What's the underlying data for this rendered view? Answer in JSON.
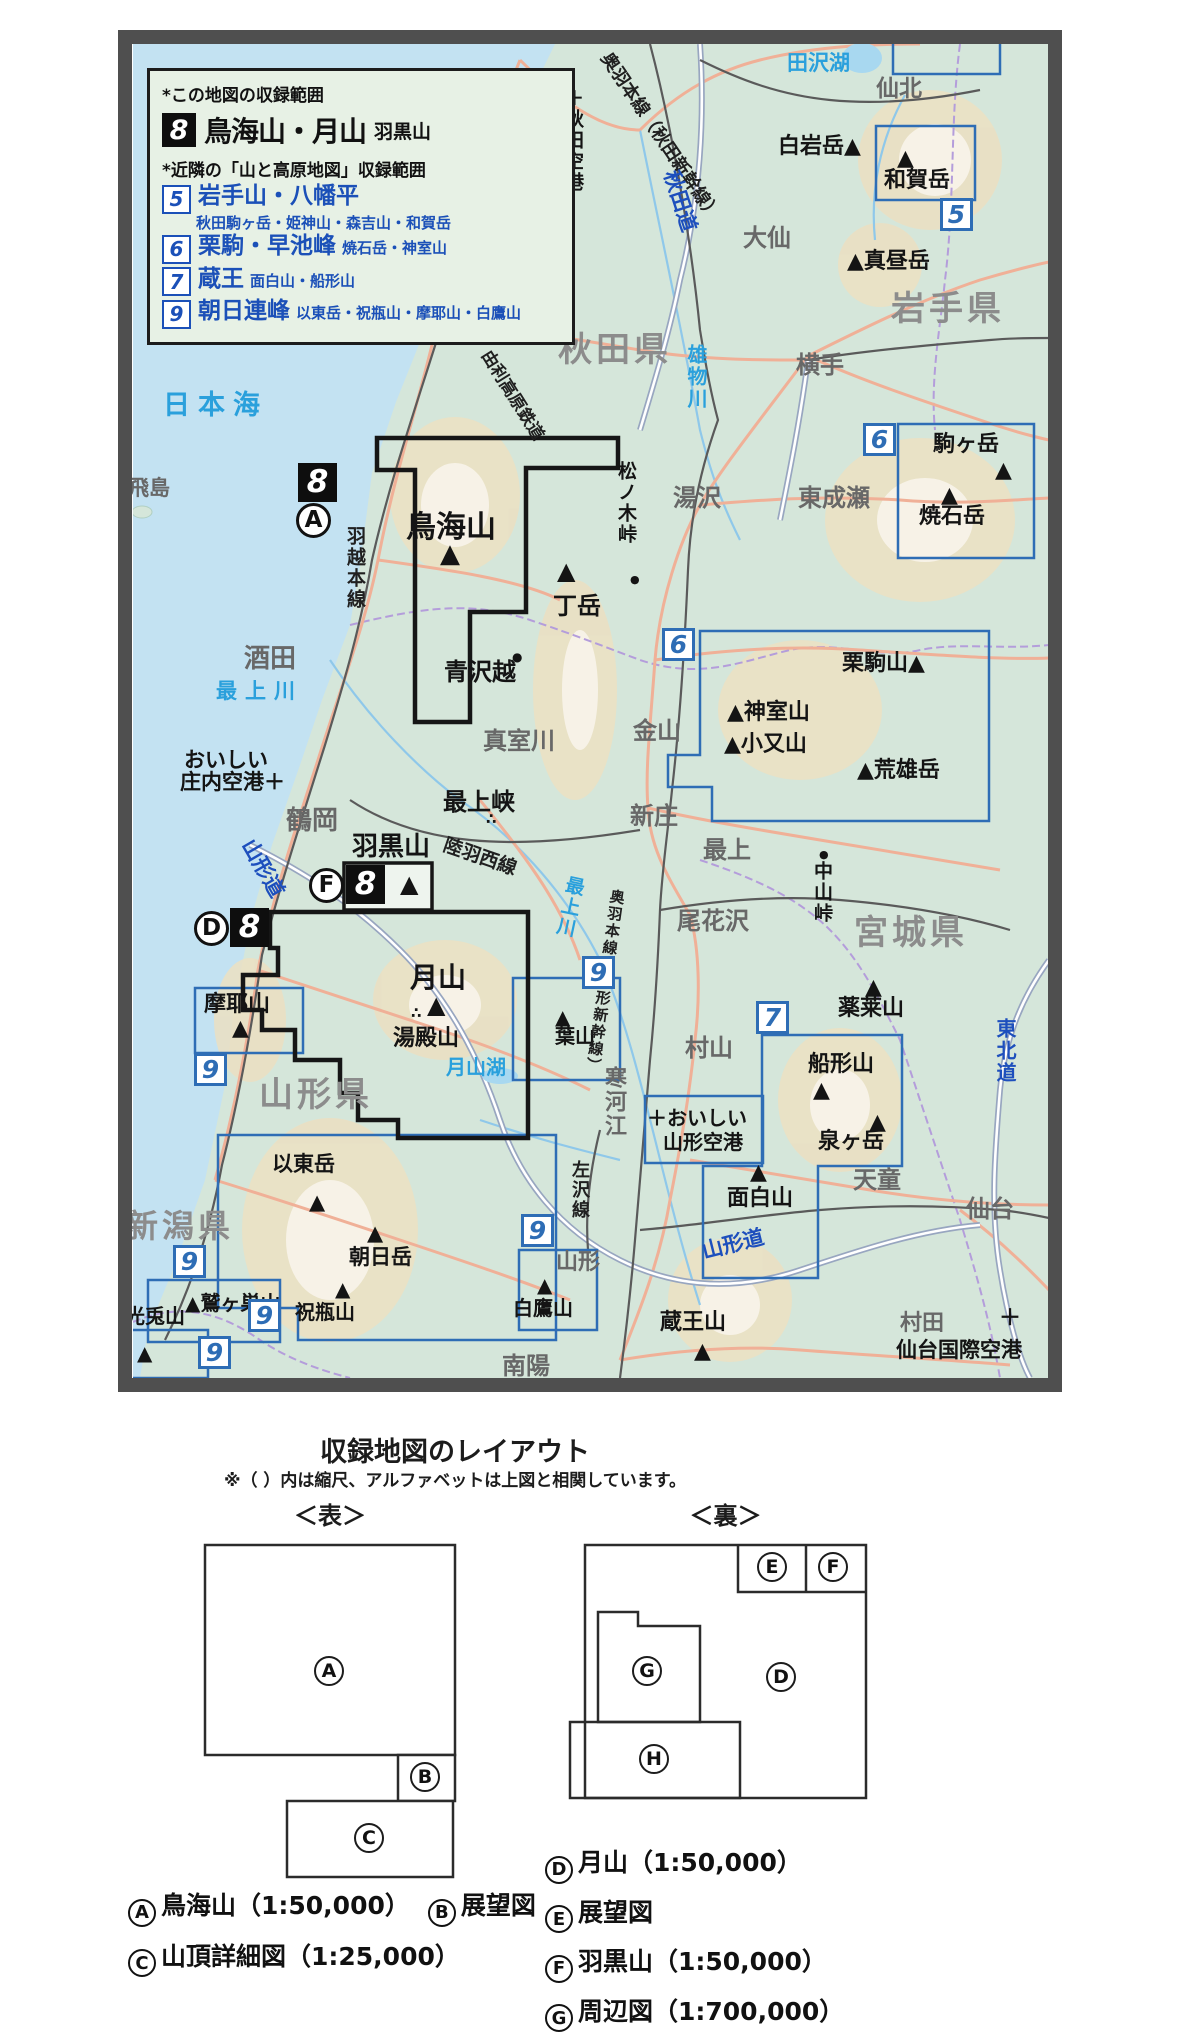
{
  "legend": {
    "note_this": "*この地図の収録範囲",
    "main": {
      "num": "8",
      "title": "鳥海山・月山",
      "sub": "羽黒山"
    },
    "note_nearby": "*近隣の「山と高原地図」収録範囲",
    "items": [
      {
        "num": "5",
        "title": "岩手山・八幡平",
        "sub": "秋田駒ヶ岳・姫神山・森吉山・和賀岳",
        "wrap": true
      },
      {
        "num": "6",
        "title": "栗駒・早池峰",
        "sub": "焼石岳・神室山"
      },
      {
        "num": "7",
        "title": "蔵王",
        "sub": "面白山・船形山"
      },
      {
        "num": "9",
        "title": "朝日連峰",
        "sub": "以東岳・祝瓶山・摩耶山・白鷹山"
      }
    ]
  },
  "map": {
    "sea_color": "#c3e2f2",
    "land_color": "#d5e6da",
    "coverage_box_color": "#2e6db5",
    "region_border_color": "#161616",
    "labels": [
      {
        "n": "label-nihonkai",
        "t": "日本海",
        "x": 163,
        "y": 392,
        "c": "water ls",
        "f": 27
      },
      {
        "n": "label-tazawako",
        "t": "田沢湖",
        "x": 787,
        "y": 53,
        "c": "water",
        "f": 21
      },
      {
        "n": "label-omonogawa",
        "t": "雄物川",
        "x": 686,
        "y": 344,
        "c": "water v",
        "f": 20
      },
      {
        "n": "label-mogamigawa",
        "t": "最上川",
        "x": 216,
        "y": 681,
        "c": "water ls",
        "f": 21
      },
      {
        "n": "label-mogamigawa-2",
        "t": "最上川",
        "x": 566,
        "y": 874,
        "c": "water v",
        "f": 19,
        "r": 12
      },
      {
        "n": "label-gassanko",
        "t": "月山湖",
        "x": 446,
        "y": 1057,
        "c": "water",
        "f": 20
      },
      {
        "n": "label-akita-pref",
        "t": "秋田県",
        "x": 558,
        "y": 333,
        "c": "pref",
        "f": 34
      },
      {
        "n": "label-iwate-pref",
        "t": "岩手県",
        "x": 891,
        "y": 292,
        "c": "pref",
        "f": 34
      },
      {
        "n": "label-miyagi-pref",
        "t": "宮城県",
        "x": 854,
        "y": 916,
        "c": "pref",
        "f": 34
      },
      {
        "n": "label-yamagata-pref",
        "t": "山形県",
        "x": 259,
        "y": 1078,
        "c": "pref",
        "f": 34
      },
      {
        "n": "label-niigata-pref",
        "t": "新潟県",
        "x": 126,
        "y": 1210,
        "c": "pref",
        "f": 32
      },
      {
        "n": "label-senboku",
        "t": "仙北",
        "x": 876,
        "y": 78,
        "c": "city",
        "f": 23
      },
      {
        "n": "label-daisen",
        "t": "大仙",
        "x": 743,
        "y": 226,
        "c": "city",
        "f": 24
      },
      {
        "n": "label-yokote",
        "t": "横手",
        "x": 796,
        "y": 353,
        "c": "city",
        "f": 24
      },
      {
        "n": "label-yurihonjo",
        "t": "由利本荘",
        "x": 473,
        "y": 307,
        "c": "city",
        "f": 22
      },
      {
        "n": "label-yuzawa",
        "t": "湯沢",
        "x": 673,
        "y": 486,
        "c": "city",
        "f": 24
      },
      {
        "n": "label-higashinaruse",
        "t": "東成瀬",
        "x": 798,
        "y": 486,
        "c": "city",
        "f": 24
      },
      {
        "n": "label-sakata",
        "t": "酒田",
        "x": 244,
        "y": 646,
        "c": "city",
        "f": 26
      },
      {
        "n": "label-tsuruoka",
        "t": "鶴岡",
        "x": 286,
        "y": 808,
        "c": "city",
        "f": 26
      },
      {
        "n": "label-mamurogawa",
        "t": "真室川",
        "x": 483,
        "y": 729,
        "c": "city",
        "f": 24
      },
      {
        "n": "label-kaneyama",
        "t": "金山",
        "x": 633,
        "y": 719,
        "c": "city",
        "f": 24
      },
      {
        "n": "label-shinjo",
        "t": "新庄",
        "x": 630,
        "y": 804,
        "c": "city",
        "f": 24
      },
      {
        "n": "label-mogami",
        "t": "最上",
        "x": 703,
        "y": 838,
        "c": "city",
        "f": 24
      },
      {
        "n": "label-obanazawa",
        "t": "尾花沢",
        "x": 677,
        "y": 909,
        "c": "city",
        "f": 24
      },
      {
        "n": "label-murayama",
        "t": "村山",
        "x": 685,
        "y": 1036,
        "c": "city",
        "f": 24
      },
      {
        "n": "label-tendo",
        "t": "天童",
        "x": 853,
        "y": 1168,
        "c": "city",
        "f": 24
      },
      {
        "n": "label-sagae",
        "t": "寒河江",
        "x": 602,
        "y": 1066,
        "c": "city v",
        "f": 22
      },
      {
        "n": "label-nanyo",
        "t": "南陽",
        "x": 502,
        "y": 1354,
        "c": "city",
        "f": 24
      },
      {
        "n": "label-sendai",
        "t": "仙台",
        "x": 966,
        "y": 1197,
        "c": "city",
        "f": 24
      },
      {
        "n": "label-murata",
        "t": "村田",
        "x": 900,
        "y": 1313,
        "c": "city",
        "f": 22
      },
      {
        "n": "label-yamagata-city",
        "t": "山形",
        "x": 556,
        "y": 1252,
        "c": "city",
        "f": 22
      },
      {
        "n": "label-tobishima",
        "t": "飛島",
        "x": 128,
        "y": 478,
        "c": "city",
        "f": 21
      },
      {
        "n": "label-shiraiwadake",
        "t": "白岩岳▲",
        "x": 778,
        "y": 136,
        "c": "mtn",
        "f": 22
      },
      {
        "n": "label-mahirudake",
        "t": "▲真昼岳",
        "x": 847,
        "y": 251,
        "c": "mtn",
        "f": 22
      },
      {
        "n": "mark-wagadake",
        "t": "▲",
        "x": 897,
        "y": 148,
        "c": "mtn",
        "f": 22
      },
      {
        "n": "label-wagadake",
        "t": "和賀岳",
        "x": 884,
        "y": 170,
        "c": "mtn",
        "f": 22
      },
      {
        "n": "label-komagatake",
        "t": "駒ヶ岳",
        "x": 933,
        "y": 434,
        "c": "mtn",
        "f": 22
      },
      {
        "n": "mark-komagatake",
        "t": "▲",
        "x": 995,
        "y": 460,
        "c": "mtn",
        "f": 22
      },
      {
        "n": "mark-yakeishidake",
        "t": "▲",
        "x": 941,
        "y": 485,
        "c": "mtn",
        "f": 22
      },
      {
        "n": "label-yakeishidake",
        "t": "焼石岳",
        "x": 919,
        "y": 506,
        "c": "mtn",
        "f": 22
      },
      {
        "n": "label-chokaisan",
        "t": "鳥海山",
        "x": 406,
        "y": 513,
        "c": "mtn",
        "f": 30
      },
      {
        "n": "mark-chokaisan",
        "t": "▲",
        "x": 440,
        "y": 541,
        "c": "mtn",
        "f": 26
      },
      {
        "n": "mark-hinokamidake",
        "t": "▲",
        "x": 557,
        "y": 559,
        "c": "mtn",
        "f": 24
      },
      {
        "n": "label-hinokamidake",
        "t": "丁岳",
        "x": 553,
        "y": 594,
        "c": "mtn",
        "f": 24
      },
      {
        "n": "label-kurikomayama",
        "t": "栗駒山▲",
        "x": 842,
        "y": 653,
        "c": "mtn",
        "f": 22
      },
      {
        "n": "label-kamuroyama",
        "t": "▲神室山",
        "x": 727,
        "y": 702,
        "c": "mtn",
        "f": 22
      },
      {
        "n": "label-komatayama",
        "t": "▲小又山",
        "x": 724,
        "y": 734,
        "c": "mtn",
        "f": 22
      },
      {
        "n": "label-araodake",
        "t": "▲荒雄岳",
        "x": 857,
        "y": 760,
        "c": "mtn",
        "f": 22
      },
      {
        "n": "mark-yakuraisan",
        "t": "▲",
        "x": 865,
        "y": 977,
        "c": "mtn",
        "f": 22
      },
      {
        "n": "label-yakuraisan",
        "t": "薬莱山",
        "x": 838,
        "y": 998,
        "c": "mtn",
        "f": 22
      },
      {
        "n": "label-funagatayama",
        "t": "船形山",
        "x": 808,
        "y": 1054,
        "c": "mtn",
        "f": 22
      },
      {
        "n": "mark-funagatayama",
        "t": "▲",
        "x": 813,
        "y": 1080,
        "c": "mtn",
        "f": 22
      },
      {
        "n": "mark-izumigatake",
        "t": "▲",
        "x": 869,
        "y": 1112,
        "c": "mtn",
        "f": 22
      },
      {
        "n": "label-izumigatake",
        "t": "泉ヶ岳",
        "x": 818,
        "y": 1131,
        "c": "mtn",
        "f": 22
      },
      {
        "n": "mark-omoshiroyama",
        "t": "▲",
        "x": 750,
        "y": 1162,
        "c": "mtn",
        "f": 22
      },
      {
        "n": "label-omoshiroyama",
        "t": "面白山",
        "x": 727,
        "y": 1188,
        "c": "mtn",
        "f": 22
      },
      {
        "n": "label-zaozan",
        "t": "蔵王山",
        "x": 660,
        "y": 1312,
        "c": "mtn",
        "f": 22
      },
      {
        "n": "mark-zaozan",
        "t": "▲",
        "x": 694,
        "y": 1341,
        "c": "mtn",
        "f": 22
      },
      {
        "n": "label-gassan",
        "t": "月山",
        "x": 410,
        "y": 964,
        "c": "mtn",
        "f": 28
      },
      {
        "n": "mark-gassan",
        "t": "▲",
        "x": 427,
        "y": 993,
        "c": "mtn",
        "f": 24
      },
      {
        "n": "dots-yudonosan",
        "t": "∴",
        "x": 411,
        "y": 1006,
        "c": "mtn",
        "f": 15
      },
      {
        "n": "label-yudonosan",
        "t": "湯殿山",
        "x": 393,
        "y": 1028,
        "c": "mtn",
        "f": 22
      },
      {
        "n": "label-hagurosan",
        "t": "羽黒山",
        "x": 352,
        "y": 834,
        "c": "mtn",
        "f": 26
      },
      {
        "n": "mark-hagurosan",
        "t": "▲",
        "x": 400,
        "y": 872,
        "c": "mtn",
        "f": 24
      },
      {
        "n": "label-mayasan",
        "t": "摩耶山",
        "x": 204,
        "y": 994,
        "c": "mtn",
        "f": 22
      },
      {
        "n": "mark-mayasan",
        "t": "▲",
        "x": 232,
        "y": 1018,
        "c": "mtn",
        "f": 22
      },
      {
        "n": "mark-hayama",
        "t": "▲",
        "x": 555,
        "y": 1007,
        "c": "mtn",
        "f": 20
      },
      {
        "n": "label-hayama",
        "t": "葉山",
        "x": 555,
        "y": 1026,
        "c": "mtn",
        "f": 20
      },
      {
        "n": "label-itodake",
        "t": "以東岳",
        "x": 272,
        "y": 1154,
        "c": "mtn",
        "f": 21
      },
      {
        "n": "mark-itodake",
        "t": "▲",
        "x": 309,
        "y": 1192,
        "c": "mtn",
        "f": 21
      },
      {
        "n": "label-washigasuyama",
        "t": "▲鷲ヶ巣山",
        "x": 185,
        "y": 1293,
        "c": "mtn",
        "f": 20
      },
      {
        "n": "label-kosagiyama",
        "t": "光兎山",
        "x": 125,
        "y": 1306,
        "c": "mtn",
        "f": 20
      },
      {
        "n": "mark-kosagiyama",
        "t": "▲",
        "x": 137,
        "y": 1343,
        "c": "mtn",
        "f": 20
      },
      {
        "n": "mark-asahidake",
        "t": "▲",
        "x": 367,
        "y": 1223,
        "c": "mtn",
        "f": 21
      },
      {
        "n": "label-asahidake",
        "t": "朝日岳",
        "x": 349,
        "y": 1247,
        "c": "mtn",
        "f": 21
      },
      {
        "n": "mark-iwaibegamiyama",
        "t": "▲",
        "x": 335,
        "y": 1279,
        "c": "mtn",
        "f": 20
      },
      {
        "n": "label-iwaibegamiyama",
        "t": "祝瓶山",
        "x": 295,
        "y": 1302,
        "c": "mtn",
        "f": 20
      },
      {
        "n": "mark-shirataka",
        "t": "▲",
        "x": 537,
        "y": 1275,
        "c": "mtn",
        "f": 20
      },
      {
        "n": "label-shirataka",
        "t": "白鷹山",
        "x": 513,
        "y": 1298,
        "c": "mtn",
        "f": 20
      },
      {
        "n": "label-matsunokitoge",
        "t": "松ノ木峠",
        "x": 616,
        "y": 461,
        "c": "mtn v",
        "f": 19
      },
      {
        "n": "dot-matsunokitoge",
        "t": "●",
        "x": 630,
        "y": 574,
        "c": "mtn",
        "f": 11
      },
      {
        "n": "dot-nakayamatoge",
        "t": "●",
        "x": 819,
        "y": 849,
        "c": "mtn",
        "f": 11
      },
      {
        "n": "label-nakayamatoge",
        "t": "中山峠",
        "x": 812,
        "y": 861,
        "c": "mtn v",
        "f": 19
      },
      {
        "n": "dot-aosawagoe",
        "t": "●",
        "x": 512,
        "y": 651,
        "c": "mtn",
        "f": 12
      },
      {
        "n": "label-aosawagoe",
        "t": "青沢越",
        "x": 444,
        "y": 660,
        "c": "mtn",
        "f": 24
      },
      {
        "n": "label-mogamikyo",
        "t": "最上峡",
        "x": 443,
        "y": 790,
        "c": "mtn",
        "f": 24
      },
      {
        "n": "dots-mogamikyo",
        "t": "∴",
        "x": 486,
        "y": 812,
        "c": "mtn",
        "f": 15
      },
      {
        "n": "label-nishimekaigan",
        "t": "西目海岸",
        "x": 295,
        "y": 315,
        "c": "mtn",
        "f": 22
      },
      {
        "n": "dots-nishimekaigan",
        "t": "∴",
        "x": 411,
        "y": 317,
        "c": "mtn",
        "f": 15
      },
      {
        "n": "label-ou-line-akita",
        "t": "奥羽本線（秋田新幹線）",
        "x": 612,
        "y": 50,
        "c": "rail",
        "f": 18,
        "r": 56
      },
      {
        "n": "label-uetsu-line",
        "t": "羽越本線",
        "x": 345,
        "y": 526,
        "c": "rail v",
        "f": 19
      },
      {
        "n": "label-yurikogen-rail",
        "t": "由利高原鉄道",
        "x": 492,
        "y": 348,
        "c": "rail",
        "f": 17,
        "r": 58
      },
      {
        "n": "label-rikuu-west-line",
        "t": "陸羽西線",
        "x": 447,
        "y": 836,
        "c": "rail",
        "f": 19,
        "r": 19
      },
      {
        "n": "label-ou-line-yamagata",
        "t": "奥羽本線（山形新幹線）",
        "x": 610,
        "y": 888,
        "c": "rail v",
        "f": 15,
        "r": 8
      },
      {
        "n": "label-aterazawa-line",
        "t": "左沢線",
        "x": 570,
        "y": 1160,
        "c": "rail v",
        "f": 18
      },
      {
        "n": "label-akita-expwy",
        "t": "秋田道",
        "x": 680,
        "y": 168,
        "c": "road",
        "f": 21,
        "r": 72
      },
      {
        "n": "label-yamagata-expwy-1",
        "t": "山形道",
        "x": 256,
        "y": 836,
        "c": "road",
        "f": 21,
        "r": 60
      },
      {
        "n": "label-yamagata-expwy-2",
        "t": "山形道",
        "x": 700,
        "y": 1242,
        "c": "road",
        "f": 21,
        "r": -14
      },
      {
        "n": "label-tohoku-expwy",
        "t": "東北道",
        "x": 995,
        "y": 1018,
        "c": "road v",
        "f": 20
      },
      {
        "n": "label-akita-airport",
        "t": "＋秋田空港",
        "x": 563,
        "y": 88,
        "c": "mtn v",
        "f": 19
      },
      {
        "n": "label-shonai-airport-1",
        "t": "おいしい",
        "x": 184,
        "y": 750,
        "c": "mtn",
        "f": 21
      },
      {
        "n": "label-shonai-airport-2",
        "t": "庄内空港＋",
        "x": 180,
        "y": 772,
        "c": "mtn",
        "f": 21
      },
      {
        "n": "label-yamagata-airport-1",
        "t": "＋おいしい",
        "x": 647,
        "y": 1108,
        "c": "mtn",
        "f": 20
      },
      {
        "n": "label-yamagata-airport-2",
        "t": "山形空港",
        "x": 663,
        "y": 1132,
        "c": "mtn",
        "f": 20
      },
      {
        "n": "cross-sendai-airport",
        "t": "＋",
        "x": 999,
        "y": 1308,
        "c": "mtn",
        "f": 22
      },
      {
        "n": "label-sendai-airport",
        "t": "仙台国際空港",
        "x": 896,
        "y": 1340,
        "c": "mtn",
        "f": 21
      }
    ],
    "badges": [
      {
        "n": "badge-5",
        "t": "5",
        "x": 940,
        "y": 198,
        "c": "blue"
      },
      {
        "n": "badge-6-small",
        "t": "6",
        "x": 863,
        "y": 423,
        "c": "blue"
      },
      {
        "n": "badge-6-large",
        "t": "6",
        "x": 662,
        "y": 628,
        "c": "blue"
      },
      {
        "n": "badge-7",
        "t": "7",
        "x": 756,
        "y": 1001,
        "c": "blue"
      },
      {
        "n": "badge-9-hayama",
        "t": "9",
        "x": 582,
        "y": 956,
        "c": "blue"
      },
      {
        "n": "badge-9-maya",
        "t": "9",
        "x": 194,
        "y": 1053,
        "c": "blue"
      },
      {
        "n": "badge-9-washigasu",
        "t": "9",
        "x": 173,
        "y": 1245,
        "c": "blue"
      },
      {
        "n": "badge-9-kosagi",
        "t": "9",
        "x": 198,
        "y": 1336,
        "c": "blue"
      },
      {
        "n": "badge-9-iwaibegami",
        "t": "9",
        "x": 248,
        "y": 1299,
        "c": "blue"
      },
      {
        "n": "badge-9-shirataka",
        "t": "9",
        "x": 521,
        "y": 1214,
        "c": "blue"
      },
      {
        "n": "badge-8-a",
        "t": "8",
        "x": 298,
        "y": 463,
        "c": "black"
      },
      {
        "n": "circle-a",
        "t": "A",
        "x": 296,
        "y": 503,
        "c": "circle"
      },
      {
        "n": "badge-8-f",
        "t": "8",
        "x": 346,
        "y": 865,
        "c": "black"
      },
      {
        "n": "circle-f",
        "t": "F",
        "x": 309,
        "y": 868,
        "c": "circle"
      },
      {
        "n": "badge-8-d",
        "t": "8",
        "x": 230,
        "y": 908,
        "c": "black"
      },
      {
        "n": "circle-d",
        "t": "D",
        "x": 194,
        "y": 911,
        "c": "circle"
      }
    ]
  },
  "layout_section": {
    "title": "収録地図のレイアウト",
    "note": "※（ ）内は縮尺、アルファベットは上図と相関しています。",
    "front": {
      "heading": "＜表＞",
      "letters": [
        {
          "n": "diagram-cell-a",
          "t": "A",
          "x": 314,
          "y": 1656
        },
        {
          "n": "diagram-cell-b",
          "t": "B",
          "x": 410,
          "y": 1762
        },
        {
          "n": "diagram-cell-c",
          "t": "C",
          "x": 354,
          "y": 1823
        }
      ]
    },
    "back": {
      "heading": "＜裏＞",
      "letters": [
        {
          "n": "diagram-cell-e",
          "t": "E",
          "x": 757,
          "y": 1552
        },
        {
          "n": "diagram-cell-f",
          "t": "F",
          "x": 818,
          "y": 1552
        },
        {
          "n": "diagram-cell-g",
          "t": "G",
          "x": 632,
          "y": 1656
        },
        {
          "n": "diagram-cell-d",
          "t": "D",
          "x": 766,
          "y": 1662
        },
        {
          "n": "diagram-cell-h",
          "t": "H",
          "x": 639,
          "y": 1744
        }
      ]
    },
    "captions_front": [
      {
        "letter": "A",
        "text": "鳥海山（1:50,000）"
      },
      {
        "letter": "B",
        "text": "展望図"
      },
      {
        "letter": "C",
        "text": "山頂詳細図（1:25,000）"
      }
    ],
    "captions_back": [
      {
        "letter": "D",
        "text": "月山（1:50,000）"
      },
      {
        "letter": "E",
        "text": "展望図"
      },
      {
        "letter": "F",
        "text": "羽黒山（1:50,000）"
      },
      {
        "letter": "G",
        "text": "周辺図（1:700,000）"
      },
      {
        "letter": "H",
        "text": "アクセス案内"
      }
    ]
  }
}
